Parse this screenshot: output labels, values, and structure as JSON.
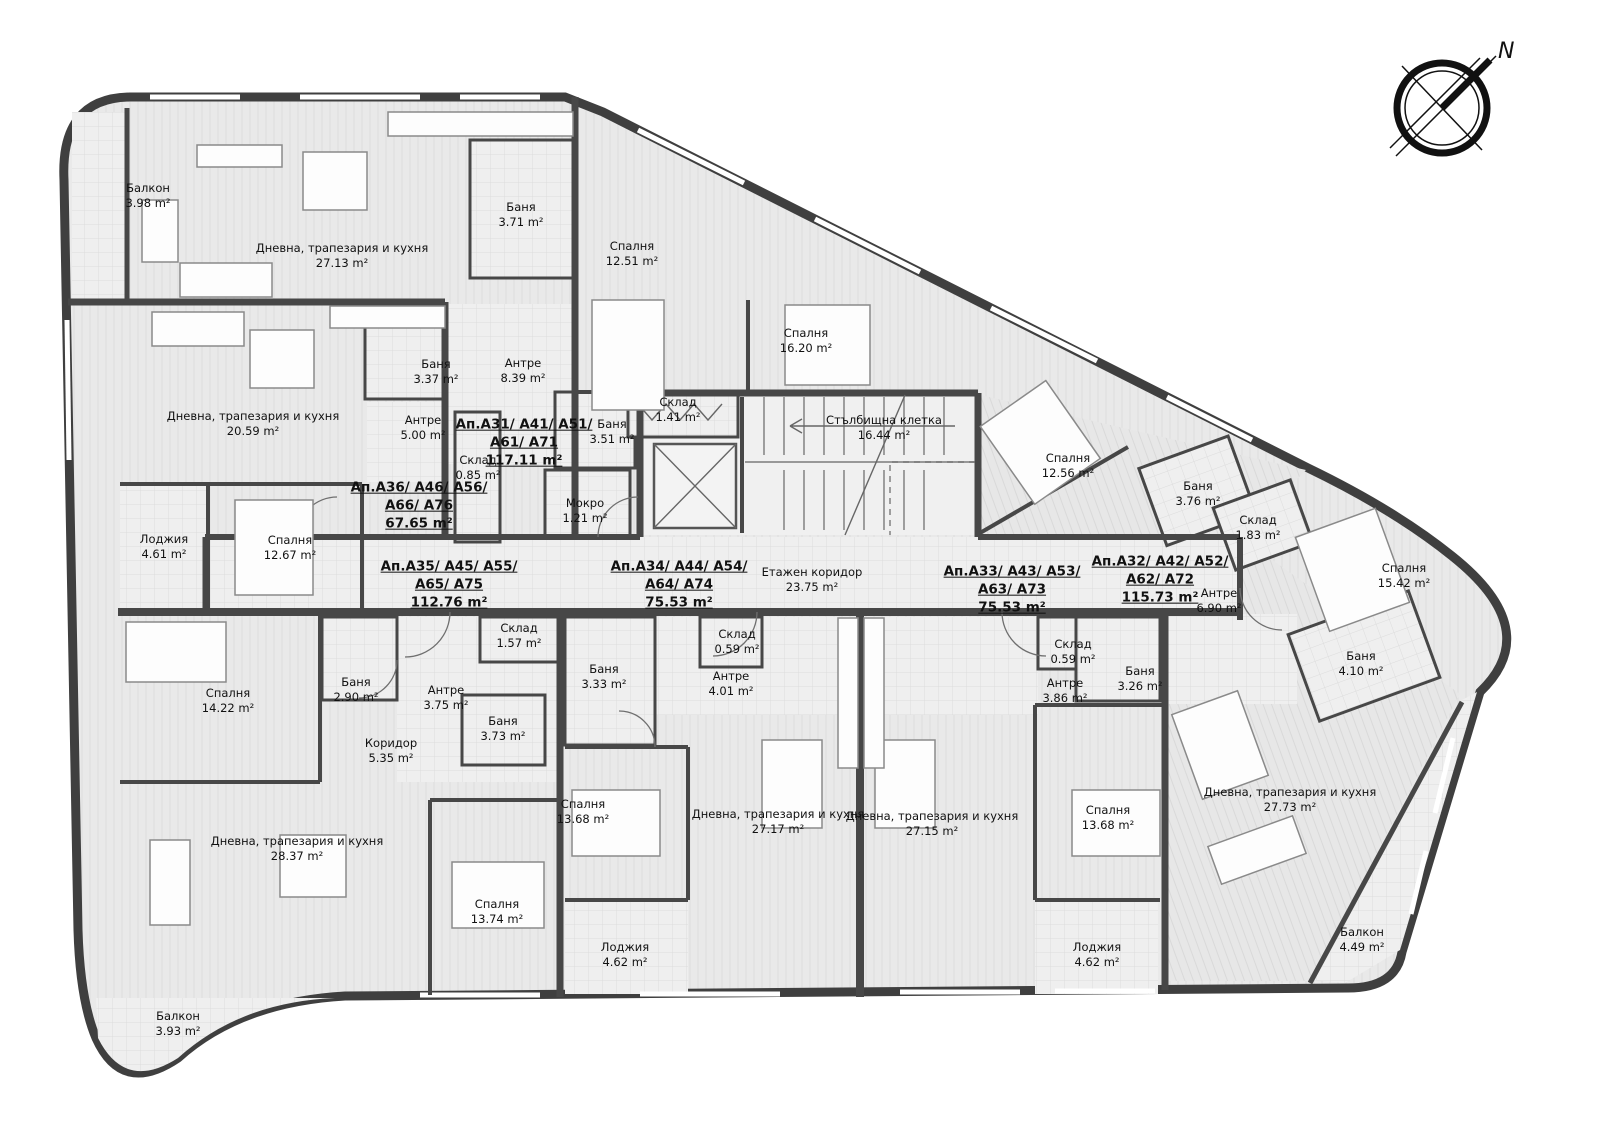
{
  "palette": {
    "wall": "#474747",
    "outline": "#3f3f3f",
    "label": "#111111",
    "floor": "#e9e9e9",
    "tile": "#efefef"
  },
  "compass": {
    "label": "N"
  },
  "apartments": [
    {
      "lines": [
        "Ап.А31/ А41/ А51/",
        "А61/ А71"
      ],
      "area": "117.11 m²",
      "x": 524,
      "y": 443
    },
    {
      "lines": [
        "Ап.А36/ А46/ А56/",
        "А66/ А76"
      ],
      "area": "67.65 m²",
      "x": 419,
      "y": 506
    },
    {
      "lines": [
        "Ап.А35/ А45/ А55/",
        "А65/ А75"
      ],
      "area": "112.76 m²",
      "x": 449,
      "y": 585
    },
    {
      "lines": [
        "Ап.А34/ А44/ А54/",
        "А64/ А74"
      ],
      "area": "75.53 m²",
      "x": 679,
      "y": 585
    },
    {
      "lines": [
        "Ап.А33/ А43/ А53/",
        "А63/ А73"
      ],
      "area": "75.53 m²",
      "x": 1012,
      "y": 590
    },
    {
      "lines": [
        "Ап.А32/ А42/ А52/",
        "А62/ А72"
      ],
      "area": "115.73 m²",
      "x": 1160,
      "y": 580
    }
  ],
  "rooms": [
    {
      "name": "Балкон",
      "area": "3.98 m²",
      "x": 148,
      "y": 196
    },
    {
      "name": "Дневна, трапезария и кухня",
      "area": "27.13 m²",
      "x": 342,
      "y": 256
    },
    {
      "name": "Баня",
      "area": "3.71 m²",
      "x": 521,
      "y": 215
    },
    {
      "name": "Спалня",
      "area": "12.51 m²",
      "x": 632,
      "y": 254
    },
    {
      "name": "Спалня",
      "area": "16.20 m²",
      "x": 806,
      "y": 341
    },
    {
      "name": "Дневна, трапезария и кухня",
      "area": "20.59 m²",
      "x": 253,
      "y": 424
    },
    {
      "name": "Баня",
      "area": "3.37 m²",
      "x": 436,
      "y": 372
    },
    {
      "name": "Антре",
      "area": "5.00 m²",
      "x": 423,
      "y": 428
    },
    {
      "name": "Антре",
      "area": "8.39 m²",
      "x": 523,
      "y": 371
    },
    {
      "name": "Склад",
      "area": "0.85 m²",
      "x": 478,
      "y": 468
    },
    {
      "name": "Баня",
      "area": "3.51 m²",
      "x": 612,
      "y": 432
    },
    {
      "name": "Мокро",
      "area": "1.21 m²",
      "x": 585,
      "y": 511
    },
    {
      "name": "Склад",
      "area": "1.41 m²",
      "x": 678,
      "y": 410
    },
    {
      "name": "Стълбищна клетка",
      "area": "16.44 m²",
      "x": 884,
      "y": 428
    },
    {
      "name": "Лоджия",
      "area": "4.61 m²",
      "x": 164,
      "y": 547
    },
    {
      "name": "Спалня",
      "area": "12.67 m²",
      "x": 290,
      "y": 548
    },
    {
      "name": "Етажен коридор",
      "area": "23.75 m²",
      "x": 812,
      "y": 580
    },
    {
      "name": "Спалня",
      "area": "12.56 m²",
      "x": 1068,
      "y": 466
    },
    {
      "name": "Баня",
      "area": "3.76 m²",
      "x": 1198,
      "y": 494
    },
    {
      "name": "Склад",
      "area": "1.83 m²",
      "x": 1258,
      "y": 528
    },
    {
      "name": "Антре",
      "area": "6.90 m²",
      "x": 1219,
      "y": 601
    },
    {
      "name": "Спалня",
      "area": "15.42 m²",
      "x": 1404,
      "y": 576
    },
    {
      "name": "Баня",
      "area": "4.10 m²",
      "x": 1361,
      "y": 664
    },
    {
      "name": "Спалня",
      "area": "14.22 m²",
      "x": 228,
      "y": 701
    },
    {
      "name": "Баня",
      "area": "2.90 m²",
      "x": 356,
      "y": 690
    },
    {
      "name": "Антре",
      "area": "3.75 m²",
      "x": 446,
      "y": 698
    },
    {
      "name": "Склад",
      "area": "1.57 m²",
      "x": 519,
      "y": 636
    },
    {
      "name": "Баня",
      "area": "3.73 m²",
      "x": 503,
      "y": 729
    },
    {
      "name": "Коридор",
      "area": "5.35 m²",
      "x": 391,
      "y": 751
    },
    {
      "name": "Баня",
      "area": "3.33 m²",
      "x": 604,
      "y": 677
    },
    {
      "name": "Склад",
      "area": "0.59 m²",
      "x": 737,
      "y": 642
    },
    {
      "name": "Антре",
      "area": "4.01 m²",
      "x": 731,
      "y": 684
    },
    {
      "name": "Дневна, трапезария и кухня",
      "area": "28.37 m²",
      "x": 297,
      "y": 849
    },
    {
      "name": "Спалня",
      "area": "13.74 m²",
      "x": 497,
      "y": 912
    },
    {
      "name": "Спалня",
      "area": "13.68 m²",
      "x": 583,
      "y": 812
    },
    {
      "name": "Дневна, трапезария и кухня",
      "area": "27.17 m²",
      "x": 778,
      "y": 822
    },
    {
      "name": "Дневна, трапезария и кухня",
      "area": "27.15 m²",
      "x": 932,
      "y": 824
    },
    {
      "name": "Антре",
      "area": "3.86 m²",
      "x": 1065,
      "y": 691
    },
    {
      "name": "Баня",
      "area": "3.26 m²",
      "x": 1140,
      "y": 679
    },
    {
      "name": "Склад",
      "area": "0.59 m²",
      "x": 1073,
      "y": 652
    },
    {
      "name": "Спалня",
      "area": "13.68 m²",
      "x": 1108,
      "y": 818
    },
    {
      "name": "Дневна, трапезария и кухня",
      "area": "27.73 m²",
      "x": 1290,
      "y": 800
    },
    {
      "name": "Лоджия",
      "area": "4.62 m²",
      "x": 625,
      "y": 955
    },
    {
      "name": "Лоджия",
      "area": "4.62 m²",
      "x": 1097,
      "y": 955
    },
    {
      "name": "Балкон",
      "area": "4.49 m²",
      "x": 1362,
      "y": 940
    },
    {
      "name": "Балкон",
      "area": "3.93 m²",
      "x": 178,
      "y": 1024
    }
  ]
}
